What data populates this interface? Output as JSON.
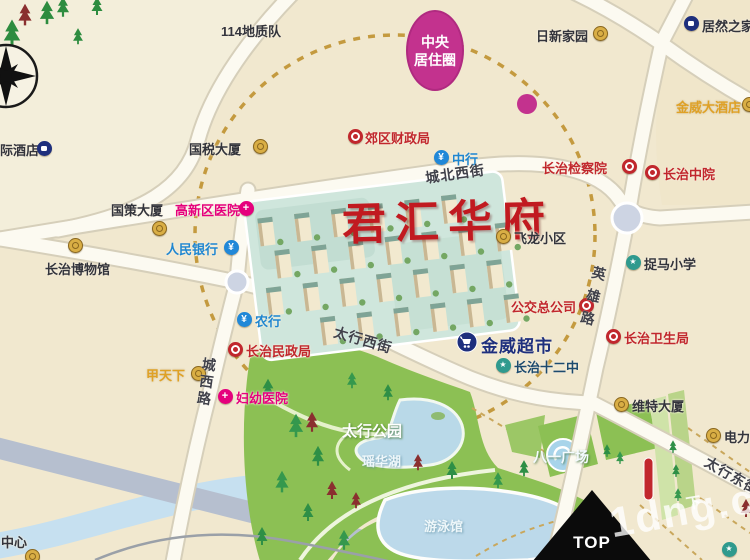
{
  "map": {
    "title": "君汇华府",
    "badge": {
      "line1": "中央",
      "line2": "居住圈"
    },
    "top_marker": "TOP",
    "watermark": {
      "text": "1dng.co",
      "cn": "下"
    },
    "colors": {
      "background": "#f1e8cf",
      "road": "#fcfaf1",
      "park_green": "#8cc054",
      "lake_blue": "#bcd9ea",
      "badge_magenta": "#c3328e",
      "circle_dash_gold": "#c49a3f",
      "title_red": "#c11a20",
      "gov_red": "#c1272d",
      "hospital_magenta": "#e5007d",
      "bank_blue": "#2188d8",
      "school_teal": "#2f9a8e",
      "navy": "#1e2f7d",
      "gold": "#d9ae45"
    },
    "streets": [
      {
        "id": "chengbei-west-street",
        "text": "城北西街",
        "x": 424,
        "y": 168,
        "rot": -8,
        "vertical": false,
        "ls": 1
      },
      {
        "id": "taihang-west-street",
        "text": "太行西街",
        "x": 337,
        "y": 322,
        "rot": 16,
        "vertical": false,
        "ls": 1
      },
      {
        "id": "yingxiong-road",
        "text": "英雄路",
        "x": 591,
        "y": 264,
        "rot": 14,
        "vertical": true,
        "ls": 9
      },
      {
        "id": "chengxi-road",
        "text": "城西路",
        "x": 200,
        "y": 356,
        "rot": 8,
        "vertical": true,
        "ls": 3
      },
      {
        "id": "taihang-east-street",
        "text": "太行东街",
        "x": 711,
        "y": 452,
        "rot": 30,
        "vertical": false,
        "ls": 1
      }
    ],
    "pois": [
      {
        "id": "intl-hotel",
        "text": "际酒店",
        "cls": "dark",
        "tx": 0,
        "ty": 140,
        "icon": "navy",
        "ix": 44,
        "iy": 148
      },
      {
        "id": "geo-team-114",
        "text": "114地质队",
        "cls": "dark",
        "tx": 221,
        "ty": 21,
        "icon": "none"
      },
      {
        "id": "rixin-home",
        "text": "日新家园",
        "cls": "dark",
        "tx": 536,
        "ty": 26,
        "icon": "gold",
        "ix": 600,
        "iy": 33
      },
      {
        "id": "juran-home",
        "text": "居然之家",
        "cls": "dark",
        "tx": 702,
        "ty": 16,
        "icon": "navy",
        "ix": 691,
        "iy": 23
      },
      {
        "id": "jinwei-hotel",
        "text": "金威大酒店",
        "cls": "goldtext",
        "tx": 676,
        "ty": 97,
        "icon": "gold",
        "ix": 749,
        "iy": 104
      },
      {
        "id": "guoshui-tower",
        "text": "国税大厦",
        "cls": "dark",
        "tx": 189,
        "ty": 139,
        "icon": "gold",
        "ix": 260,
        "iy": 146
      },
      {
        "id": "caizheng-bureau",
        "text": "郊区财政局",
        "cls": "red",
        "tx": 365,
        "ty": 128,
        "icon": "red",
        "ix": 355,
        "iy": 136
      },
      {
        "id": "boc-bank",
        "text": "中行",
        "cls": "blue",
        "tx": 452,
        "ty": 149,
        "icon": "blue",
        "ix": 441,
        "iy": 157
      },
      {
        "id": "jianchayuan",
        "text": "长治检察院",
        "cls": "red",
        "tx": 542,
        "ty": 158,
        "icon": "red",
        "ix": 629,
        "iy": 166
      },
      {
        "id": "zhongyuan-court",
        "text": "长治中院",
        "cls": "red",
        "tx": 663,
        "ty": 164,
        "icon": "red",
        "ix": 652,
        "iy": 172
      },
      {
        "id": "guoce-tower",
        "text": "国策大厦",
        "cls": "dark",
        "tx": 111,
        "ty": 200,
        "icon": "gold",
        "ix": 159,
        "iy": 228
      },
      {
        "id": "gaoxin-hospital",
        "text": "高新区医院",
        "cls": "magenta",
        "tx": 175,
        "ty": 200,
        "icon": "magenta",
        "ix": 246,
        "iy": 208
      },
      {
        "id": "renmin-bank",
        "text": "人民银行",
        "cls": "blue",
        "tx": 166,
        "ty": 239,
        "icon": "blue",
        "ix": 231,
        "iy": 247
      },
      {
        "id": "changzhi-museum",
        "text": "长治博物馆",
        "cls": "dark",
        "tx": 45,
        "ty": 259,
        "icon": "gold",
        "ix": 75,
        "iy": 245
      },
      {
        "id": "feilong-block",
        "text": "飞龙小区",
        "cls": "dark",
        "tx": 514,
        "ty": 228,
        "icon": "gold",
        "ix": 503,
        "iy": 236
      },
      {
        "id": "zhuoma-school",
        "text": "捉马小学",
        "cls": "dark",
        "tx": 644,
        "ty": 254,
        "icon": "teal",
        "ix": 633,
        "iy": 262
      },
      {
        "id": "bus-company",
        "text": "公交总公司",
        "cls": "red",
        "tx": 511,
        "ty": 297,
        "icon": "red",
        "ix": 586,
        "iy": 305
      },
      {
        "id": "weisheng-bureau",
        "text": "长治卫生局",
        "cls": "red",
        "tx": 624,
        "ty": 328,
        "icon": "red",
        "ix": 613,
        "iy": 336
      },
      {
        "id": "jinwei-market",
        "text": "金威超市",
        "cls": "navybig",
        "tx": 481,
        "ty": 332,
        "icon": "none"
      },
      {
        "id": "no12-school",
        "text": "长治十二中",
        "cls": "steel",
        "tx": 514,
        "ty": 357,
        "icon": "teal",
        "ix": 503,
        "iy": 365
      },
      {
        "id": "abc-bank",
        "text": "农行",
        "cls": "blue",
        "tx": 255,
        "ty": 311,
        "icon": "blue",
        "ix": 244,
        "iy": 319
      },
      {
        "id": "minzheng-bureau",
        "text": "长治民政局",
        "cls": "red",
        "tx": 246,
        "ty": 341,
        "icon": "red",
        "ix": 235,
        "iy": 349
      },
      {
        "id": "jiatianxia",
        "text": "甲天下",
        "cls": "goldtext",
        "tx": 146,
        "ty": 365,
        "icon": "gold",
        "ix": 198,
        "iy": 373
      },
      {
        "id": "fuyou-hospital",
        "text": "妇幼医院",
        "cls": "magenta",
        "tx": 236,
        "ty": 388,
        "icon": "magenta",
        "ix": 225,
        "iy": 396
      },
      {
        "id": "weite-tower",
        "text": "维特大厦",
        "cls": "dark",
        "tx": 632,
        "ty": 396,
        "icon": "gold",
        "ix": 621,
        "iy": 404
      },
      {
        "id": "dianli-block",
        "text": "电力小区",
        "cls": "dark",
        "tx": 724,
        "ty": 427,
        "icon": "gold",
        "ix": 713,
        "iy": 435
      },
      {
        "id": "center-partial",
        "text": "中心",
        "cls": "dark",
        "tx": 1,
        "ty": 532,
        "icon": "gold",
        "ix": 32,
        "iy": 556
      },
      {
        "id": "pool-poi-partial",
        "text": "",
        "cls": "dark",
        "tx": 742,
        "ty": 546,
        "icon": "teal",
        "ix": 729,
        "iy": 549
      },
      {
        "id": "taihang-park",
        "text": "太行公园",
        "cls": "parkname",
        "tx": 342,
        "ty": 420,
        "icon": "none"
      },
      {
        "id": "bayi-square",
        "text": "八一广场",
        "cls": "plazaname",
        "tx": 533,
        "ty": 447,
        "icon": "none"
      },
      {
        "id": "yaohua-lake",
        "text": "瑶华湖",
        "cls": "lakename",
        "tx": 362,
        "ty": 451,
        "icon": "none"
      },
      {
        "id": "swim-hall",
        "text": "游泳馆",
        "cls": "lakename",
        "tx": 424,
        "ty": 516,
        "icon": "none"
      }
    ]
  }
}
